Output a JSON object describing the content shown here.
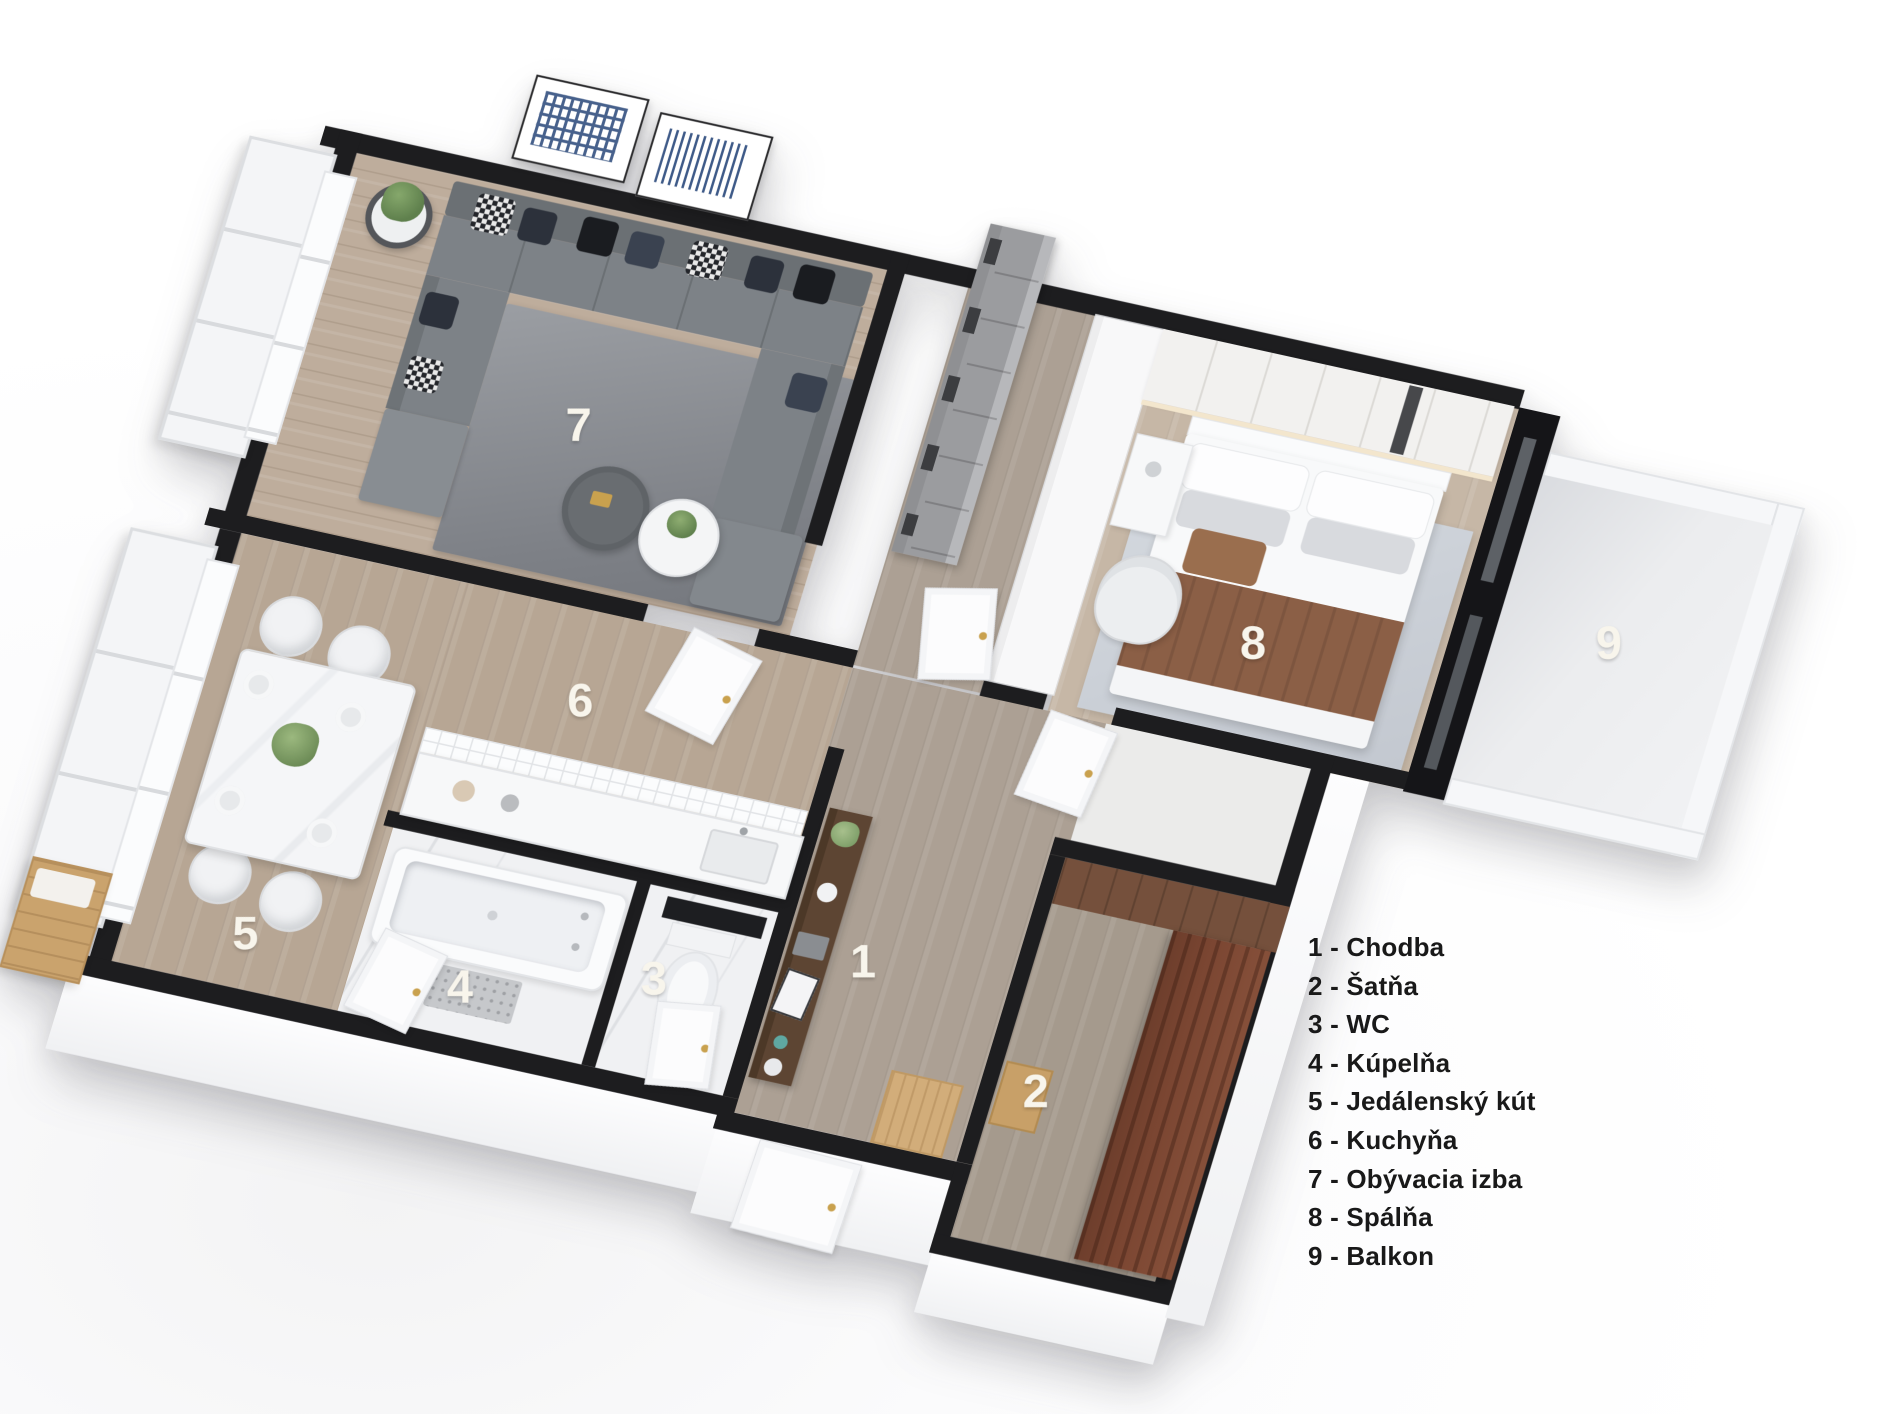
{
  "rooms": [
    {
      "number": "1",
      "name": "Chodba",
      "label_x": 748,
      "label_y": 700
    },
    {
      "number": "2",
      "name": "Šatňa",
      "label_x": 952,
      "label_y": 790
    },
    {
      "number": "3",
      "name": "WC",
      "label_x": 552,
      "label_y": 762
    },
    {
      "number": "4",
      "name": "Kúpelňa",
      "label_x": 368,
      "label_y": 812
    },
    {
      "number": "5",
      "name": "Jedálenský kút",
      "label_x": 146,
      "label_y": 806
    },
    {
      "number": "6",
      "name": "Kuchyňa",
      "label_x": 400,
      "label_y": 505
    },
    {
      "number": "7",
      "name": "Obývacia izba",
      "label_x": 318,
      "label_y": 235
    },
    {
      "number": "8",
      "name": "Spálňa",
      "label_x": 1030,
      "label_y": 303
    },
    {
      "number": "9",
      "name": "Balkon",
      "label_x": 1372,
      "label_y": 226
    }
  ],
  "legend": {
    "separator": " - "
  },
  "palette": {
    "wall_black": "#1d1d1f",
    "wood_light": "#c6b7a6",
    "wood_mid": "#b7a694",
    "wood_gray": "#aca094",
    "marble_white": "#f0f1f3",
    "rug_living": "#8d9095",
    "rug_bedroom": "#ced3da",
    "sofa_gray": "#7a7f84",
    "blanket_brown": "#8b5f46",
    "wardrobe_brown": "#7b4632",
    "bench_oak": "#caa36d",
    "handle_gold": "#c9a14e",
    "number_white": "#f8f5ec",
    "legend_text": "#191919"
  }
}
